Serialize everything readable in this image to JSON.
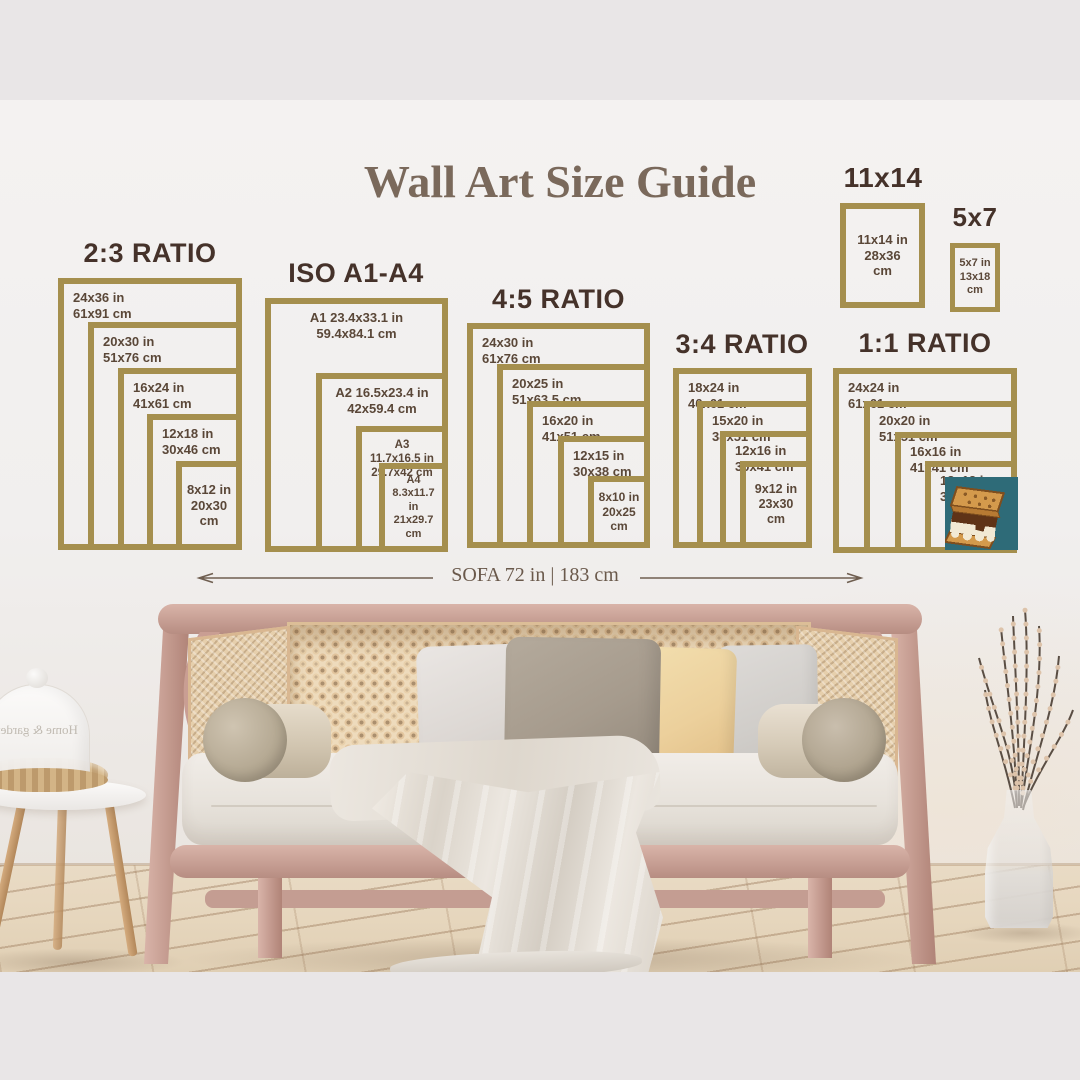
{
  "title": "Wall Art Size Guide",
  "colors": {
    "frame_gold": "#a58f4e",
    "heading_brown": "#45322a",
    "label_brown": "#5a4738",
    "title_brown": "#7a695b",
    "sticker_teal": "#2e6b78"
  },
  "groups": [
    {
      "heading": "2:3 RATIO",
      "frames": [
        {
          "in": "24x36 in",
          "cm": "61x91 cm"
        },
        {
          "in": "20x30 in",
          "cm": "51x76 cm"
        },
        {
          "in": "16x24 in",
          "cm": "41x61 cm"
        },
        {
          "in": "12x18 in",
          "cm": "30x46 cm"
        },
        {
          "in": "8x12 in",
          "cm": "20x30 cm"
        }
      ]
    },
    {
      "heading": "ISO A1-A4",
      "frames": [
        {
          "in": "A1 23.4x33.1 in",
          "cm": "59.4x84.1 cm"
        },
        {
          "in": "A2 16.5x23.4 in",
          "cm": "42x59.4 cm"
        },
        {
          "in": "A3 11.7x16.5 in",
          "cm": "29.7x42 cm"
        },
        {
          "name": "A4",
          "in": "8.3x11.7 in",
          "cm": "21x29.7 cm"
        }
      ]
    },
    {
      "heading": "4:5 RATIO",
      "frames": [
        {
          "in": "24x30 in",
          "cm": "61x76 cm"
        },
        {
          "in": "20x25 in",
          "cm": "51x63.5 cm"
        },
        {
          "in": "16x20 in",
          "cm": "41x51 cm"
        },
        {
          "in": "12x15 in",
          "cm": "30x38 cm"
        },
        {
          "in": "8x10 in",
          "cm": "20x25 cm"
        }
      ]
    },
    {
      "heading": "3:4 RATIO",
      "frames": [
        {
          "in": "18x24 in",
          "cm": "46x61 cm"
        },
        {
          "in": "15x20 in",
          "cm": "38x51 cm"
        },
        {
          "in": "12x16 in",
          "cm": "30x41 cm"
        },
        {
          "in": "9x12 in",
          "cm": "23x30 cm"
        }
      ]
    },
    {
      "heading": "1:1 RATIO",
      "frames": [
        {
          "in": "24x24 in",
          "cm": "61x61 cm"
        },
        {
          "in": "20x20 in",
          "cm": "51x51 cm"
        },
        {
          "in": "16x16 in",
          "cm": "41x41 cm"
        },
        {
          "in": "12x12 in",
          "cm": "30x30 cm"
        }
      ]
    },
    {
      "heading": "11x14",
      "frames": [
        {
          "in": "11x14 in",
          "cm": "28x36 cm"
        }
      ]
    },
    {
      "heading": "5x7",
      "frames": [
        {
          "in": "5x7 in",
          "cm": "13x18 cm"
        }
      ]
    }
  ],
  "sofa_dimension_label": "SOFA 72 in | 183 cm",
  "scene": {
    "cloche_text": "Home & garden"
  },
  "icons": {
    "sticker": "smore-icon"
  }
}
